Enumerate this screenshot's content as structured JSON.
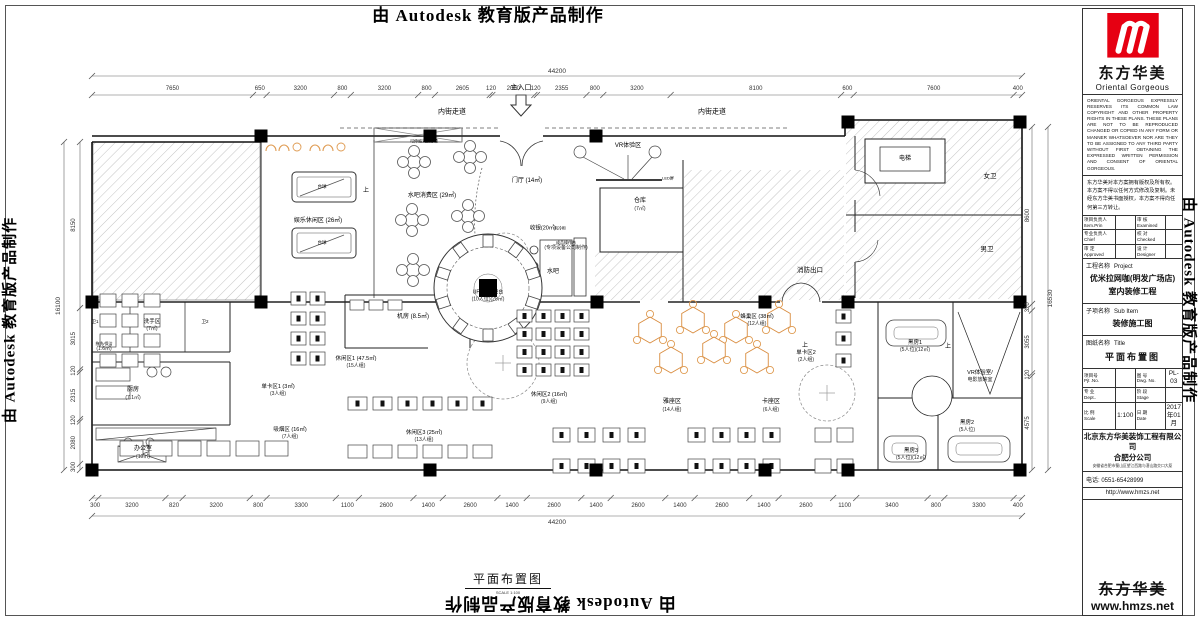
{
  "watermarks": {
    "top": "由 Autodesk 教育版产品制作",
    "left": "由 Autodesk 教育版产品制作",
    "right": "由 Autodesk 教育版产品制作",
    "bottom": "由 Autodesk 教育版产品制作"
  },
  "drawing": {
    "bottom_title": "平面布置图",
    "bottom_scale": "SCALE 1:100",
    "dims": {
      "top": {
        "total": "44200",
        "segments": [
          "7650",
          "650",
          "3200",
          "800",
          "3200",
          "800",
          "2605",
          "120",
          "2000",
          "120",
          "2355",
          "800",
          "3200",
          "8100",
          "600",
          "7600",
          "400"
        ]
      },
      "bottom": {
        "total": "44200",
        "segments": [
          "300",
          "3200",
          "820",
          "3200",
          "800",
          "3300",
          "1100",
          "2600",
          "1400",
          "2600",
          "1400",
          "2600",
          "1400",
          "2600",
          "1400",
          "2600",
          "1400",
          "2600",
          "1100",
          "3400",
          "800",
          "3300",
          "400"
        ]
      },
      "left": {
        "total": "16100",
        "segments": [
          "8150",
          "3015",
          "120",
          "2315",
          "120",
          "2080",
          "300"
        ]
      },
      "right": {
        "total": "16530",
        "segments": [
          "8600",
          "320",
          "3055",
          "120",
          "4575"
        ]
      }
    },
    "labels": [
      {
        "text": "内街走道",
        "sub": "",
        "x": 452,
        "y": 112,
        "fs": 7
      },
      {
        "text": "内街走道",
        "sub": "",
        "x": 712,
        "y": 112,
        "fs": 7
      },
      {
        "text": "主入口",
        "sub": "",
        "x": 521,
        "y": 88,
        "fs": 7
      },
      {
        "text": "娱乐休闲区 (26㎡)",
        "sub": "",
        "x": 318,
        "y": 222,
        "fs": 6
      },
      {
        "text": "台球",
        "sub": "",
        "x": 322,
        "y": 187,
        "fs": 4.5
      },
      {
        "text": "台球",
        "sub": "",
        "x": 322,
        "y": 243,
        "fs": 4.5
      },
      {
        "text": "可伸缩式投影幕",
        "sub": "",
        "x": 424,
        "y": 141,
        "fs": 4
      },
      {
        "text": "水吧消费区 (29㎡)",
        "sub": "",
        "x": 432,
        "y": 197,
        "fs": 6
      },
      {
        "text": "门厅 (14㎡)",
        "sub": "",
        "x": 527,
        "y": 182,
        "fs": 6
      },
      {
        "text": "VR体验区",
        "sub": "",
        "x": 628,
        "y": 147,
        "fs": 6
      },
      {
        "text": "LED屏",
        "sub": "",
        "x": 668,
        "y": 178,
        "fs": 4
      },
      {
        "text": "仓库",
        "sub": "(7㎡)",
        "x": 640,
        "y": 205,
        "fs": 6
      },
      {
        "text": "电梯",
        "sub": "",
        "x": 905,
        "y": 160,
        "fs": 6
      },
      {
        "text": "女卫",
        "sub": "",
        "x": 990,
        "y": 177,
        "fs": 6.5
      },
      {
        "text": "男卫",
        "sub": "",
        "x": 987,
        "y": 250,
        "fs": 6.5
      },
      {
        "text": "消防出口",
        "sub": "",
        "x": 810,
        "y": 271,
        "fs": 6.5
      },
      {
        "text": "收银(20㎡)",
        "sub": "",
        "x": 543,
        "y": 229,
        "fs": 5.5
      },
      {
        "text": "水吧",
        "sub": "",
        "x": 553,
        "y": 273,
        "fs": 6
      },
      {
        "text": "成品操作台",
        "sub": "(专项设备公司制作)",
        "x": 566,
        "y": 246,
        "fs": 4
      },
      {
        "text": "风冷柜",
        "sub": "",
        "x": 560,
        "y": 228,
        "fs": 4
      },
      {
        "text": "机房 (8.5㎡)",
        "sub": "",
        "x": 413,
        "y": 318,
        "fs": 6
      },
      {
        "text": "洗手区",
        "sub": "(7㎡)",
        "x": 152,
        "y": 326,
        "fs": 5.5
      },
      {
        "text": "卫1",
        "sub": "",
        "x": 95,
        "y": 322,
        "fs": 4.5
      },
      {
        "text": "卫2",
        "sub": "",
        "x": 205,
        "y": 322,
        "fs": 4.5
      },
      {
        "text": "拖洗/保洁",
        "sub": "(1.6㎡)",
        "x": 104,
        "y": 347,
        "fs": 4
      },
      {
        "text": "厨房",
        "sub": "(7.1㎡)",
        "x": 133,
        "y": 394,
        "fs": 6
      },
      {
        "text": "办公室",
        "sub": "(10㎡)",
        "x": 143,
        "y": 453,
        "fs": 6
      },
      {
        "text": "单卡区1 (3㎡)",
        "sub": "(3人组)",
        "x": 278,
        "y": 391,
        "fs": 5.5
      },
      {
        "text": "吸烟区 (16㎡)",
        "sub": "(7人组)",
        "x": 290,
        "y": 434,
        "fs": 5.5
      },
      {
        "text": "休闲区1 (47.5㎡)",
        "sub": "(15人组)",
        "x": 356,
        "y": 363,
        "fs": 5.5
      },
      {
        "text": "UFO飞碟吧台",
        "sub": "(10人位)(28㎡)",
        "x": 488,
        "y": 296,
        "fs": 5
      },
      {
        "text": "休闲区3 (25㎡)",
        "sub": "(13人组)",
        "x": 424,
        "y": 437,
        "fs": 5.5
      },
      {
        "text": "休闲区2 (16㎡)",
        "sub": "(9人组)",
        "x": 549,
        "y": 399,
        "fs": 5.5
      },
      {
        "text": "雅座区",
        "sub": "(14人组)",
        "x": 672,
        "y": 406,
        "fs": 6
      },
      {
        "text": "卡座区",
        "sub": "(6人组)",
        "x": 771,
        "y": 406,
        "fs": 6
      },
      {
        "text": "蜂巢区 (38㎡)",
        "sub": "(12人组)",
        "x": 757,
        "y": 321,
        "fs": 5.5
      },
      {
        "text": "单卡区2",
        "sub": "(2人组)",
        "x": 806,
        "y": 357,
        "fs": 5.5
      },
      {
        "text": "VR体验室/",
        "sub": "电影放映室",
        "x": 980,
        "y": 377,
        "fs": 5.5
      },
      {
        "text": "黑房1",
        "sub": "(5人位)(12㎡)",
        "x": 915,
        "y": 347,
        "fs": 5.5
      },
      {
        "text": "黑房2",
        "sub": "(5人位)",
        "x": 967,
        "y": 427,
        "fs": 5.5
      },
      {
        "text": "黑房3",
        "sub": "(5人位)(12㎡)",
        "x": 911,
        "y": 455,
        "fs": 5.5
      },
      {
        "text": "上",
        "sub": "",
        "x": 366,
        "y": 192,
        "fs": 6
      },
      {
        "text": "上",
        "sub": "",
        "x": 805,
        "y": 347,
        "fs": 6
      },
      {
        "text": "上",
        "sub": "",
        "x": 948,
        "y": 348,
        "fs": 6
      }
    ]
  },
  "title_block": {
    "logo_cn": "东方华美",
    "logo_en": "Oriental  Gorgeous",
    "copyright_en": "ORIENTAL GORGEOUS EXPRESSLY RESERVES ITS COMMON LAW COPYRIGHT AND OTHER PROPERTY RIGHTS IN THESE PLANS. THESE PLANS ARE NOT TO BE REPRODUCED CHANGED OR COPIED IN ANY FORM OR MANNER WHATSOEVER NOR ARE THEY TO BE ASSIGNED TO ANY THIRD PARTY WITHOUT FIRST OBTAINING THE EXPRESSED WRITTEN PERMISSION AND CONSENT OF ORIENTAL GORGEOUS.",
    "copyright_cn": "东方华美对本方案拥有版权及所有权。本方案不得以任何方式修改及复制。未经东方华美书面授权，本方案不得向任何第三方转让。",
    "personnel": [
      {
        "l_cn": "项目负责人",
        "l_en": "Item.Prin",
        "lv": "",
        "r_cn": "审 核",
        "r_en": "Examined",
        "rv": ""
      },
      {
        "l_cn": "专业负责人",
        "l_en": "Chief",
        "lv": "",
        "r_cn": "校 对",
        "r_en": "Checked",
        "rv": ""
      },
      {
        "l_cn": "审 定",
        "l_en": "Approved",
        "lv": "",
        "r_cn": "设 计",
        "r_en": "Designer",
        "rv": ""
      }
    ],
    "project_label_cn": "工程名称",
    "project_label_en": "Project",
    "project_name_1": "优米拉网咖(明发广场店)",
    "project_name_2": "室内装修工程",
    "subitem_label_cn": "子项名称",
    "subitem_label_en": "Sub Item",
    "subitem_value": "装修施工图",
    "sheet_label_cn": "图纸名称",
    "sheet_label_en": "Title",
    "sheet_value": "平面布置图",
    "info": [
      {
        "l_cn": "项目号",
        "l_en": "Pjt .No.",
        "lv": "",
        "r_cn": "图 号",
        "r_en": "Dwg. No.",
        "rv": "PL-03"
      },
      {
        "l_cn": "专 业",
        "l_en": "Dept..",
        "lv": "",
        "r_cn": "阶 段",
        "r_en": "Stage",
        "rv": ""
      },
      {
        "l_cn": "比 例",
        "l_en": "Scale",
        "lv": "1:100",
        "r_cn": "日 期",
        "r_en": "Date",
        "rv": "2017年01月"
      }
    ],
    "company_1": "北京东方华美装饰工程有限公司",
    "company_2": "合肥分公司",
    "company_addr": "安徽省合肥市蜀山区望江西路与潜山路交口大厦",
    "phone": "电话: 0551-65428999",
    "website": "http://www.hmzs.net",
    "footer_cn": "东方华美",
    "footer_url": "www.hmzs.net"
  }
}
